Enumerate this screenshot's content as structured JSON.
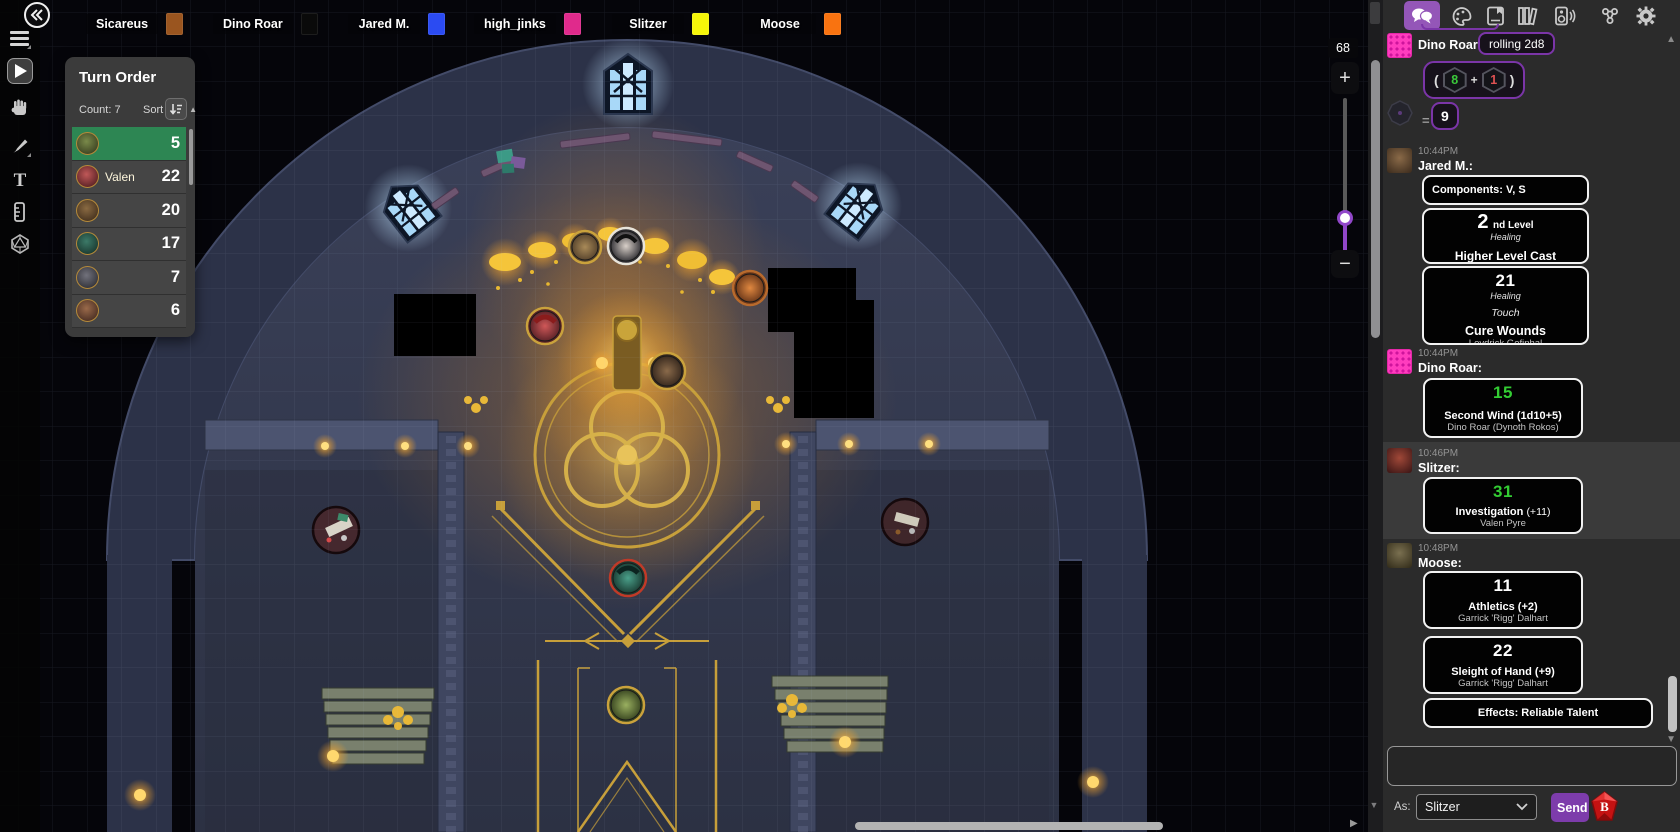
{
  "player_bar": [
    {
      "name": "Sicareus",
      "color": "#9a551f"
    },
    {
      "name": "Dino Roar",
      "color": "#0a0a0a"
    },
    {
      "name": "Jared M.",
      "color": "#2b4bf2"
    },
    {
      "name": "high_jinks",
      "color": "#e02a8c"
    },
    {
      "name": "Slitzer",
      "color": "#f6f609"
    },
    {
      "name": "Moose",
      "color": "#f97310"
    }
  ],
  "turn_order": {
    "title": "Turn Order",
    "count": "Count: 7",
    "sort_label": "Sort",
    "rows": [
      {
        "name": "",
        "value": "5"
      },
      {
        "name": "Valen",
        "value": "22"
      },
      {
        "name": "",
        "value": "20"
      },
      {
        "name": "",
        "value": "17"
      },
      {
        "name": "",
        "value": "7"
      },
      {
        "name": "",
        "value": "6"
      }
    ]
  },
  "map": {
    "zoom_value": "68",
    "zoom_in": "+",
    "zoom_out": "−"
  },
  "chat": {
    "m1": {
      "author": "Dino Roar:",
      "roll_label": "rolling 2d8",
      "paren_open": "(",
      "die1": "8",
      "plus": "+",
      "die2": "1",
      "paren_close": ")",
      "equals": "=",
      "result": "9"
    },
    "m2": {
      "time": "10:44PM",
      "author": "Jared M.:",
      "components": "Components: V, S",
      "level_big": "2",
      "level_suffix": "nd Level",
      "level_school": "Healing",
      "level_title": "Higher Level Cast",
      "heal_big": "21",
      "heal_school": "Healing",
      "heal_range": "Touch",
      "heal_title": "Cure Wounds",
      "heal_source": "Levdrick Gefinhal"
    },
    "m3": {
      "time": "10:44PM",
      "author": "Dino Roar:",
      "big": "15",
      "title": "Second Wind (1d10+5)",
      "source": "Dino Roar (Dynoth Rokos)"
    },
    "m4": {
      "time": "10:46PM",
      "author": "Slitzer:",
      "big": "31",
      "title": "Investigation",
      "title_mod": "(+11)",
      "source": "Valen Pyre"
    },
    "m5": {
      "time": "10:48PM",
      "author": "Moose:",
      "card1_big": "11",
      "card1_title": "Athletics (+2)",
      "card1_source": "Garrick 'Rigg' Dalhart",
      "card2_big": "22",
      "card2_title": "Sleight of Hand (+9)",
      "card2_source": "Garrick 'Rigg' Dalhart",
      "effects": "Effects: Reliable Talent"
    },
    "input": {
      "value": "",
      "as_label": "As:",
      "as_selected": "Slitzer",
      "send": "Send",
      "beyond20": "B"
    }
  },
  "colors": {
    "accent_purple": "#9456b8",
    "roll_purple": "#7b35a8",
    "result_green": "#33cc33",
    "die_red": "#e05252",
    "turn_active_green": "#2d8653",
    "send_purple": "#7d3cab",
    "gold": "#c79f3a",
    "sidebar_bg": "#2b2b2b",
    "highlight_row": "#3a3a3a"
  }
}
